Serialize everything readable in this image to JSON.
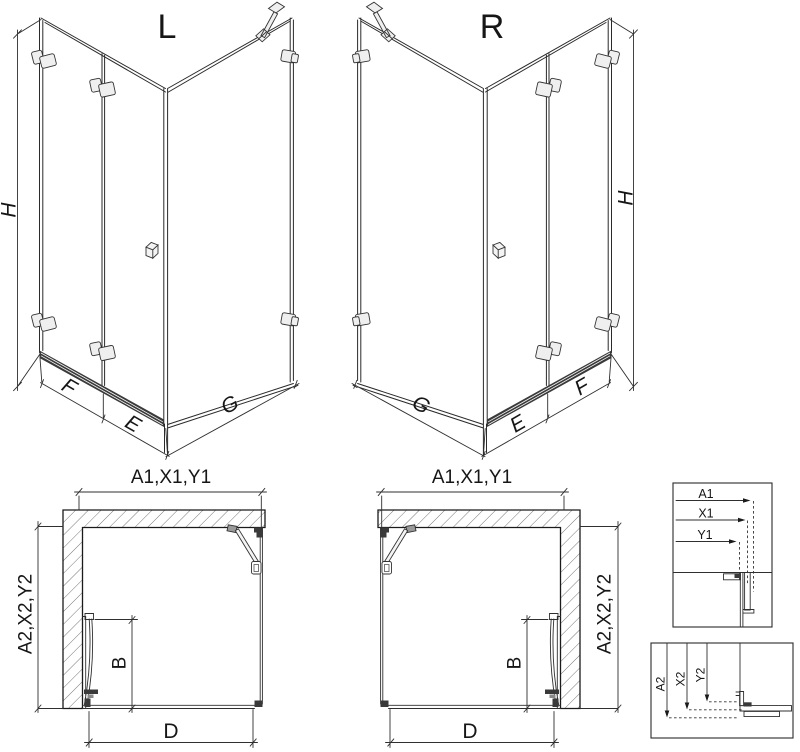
{
  "iso_left": {
    "title": "L",
    "height_label": "H",
    "segment_f": "F",
    "segment_e": "E",
    "segment_g": "G"
  },
  "iso_right": {
    "title": "R",
    "height_label": "H",
    "segment_f": "F",
    "segment_e": "E",
    "segment_g": "G"
  },
  "plan_left": {
    "top_dim": "A1,X1,Y1",
    "side_dim": "A2,X2,Y2",
    "door_dim": "B",
    "entry_dim": "D"
  },
  "plan_right": {
    "top_dim": "A1,X1,Y1",
    "side_dim": "A2,X2,Y2",
    "door_dim": "B",
    "entry_dim": "D"
  },
  "detail_horizontal": {
    "dims": [
      "A1",
      "X1",
      "Y1"
    ]
  },
  "detail_vertical": {
    "dims": [
      "A2",
      "X2",
      "Y2"
    ]
  },
  "colors": {
    "line": "#2a2a2a",
    "rail": "#3a3a3a",
    "hatch": "#666666",
    "hardware": "#efefef"
  }
}
